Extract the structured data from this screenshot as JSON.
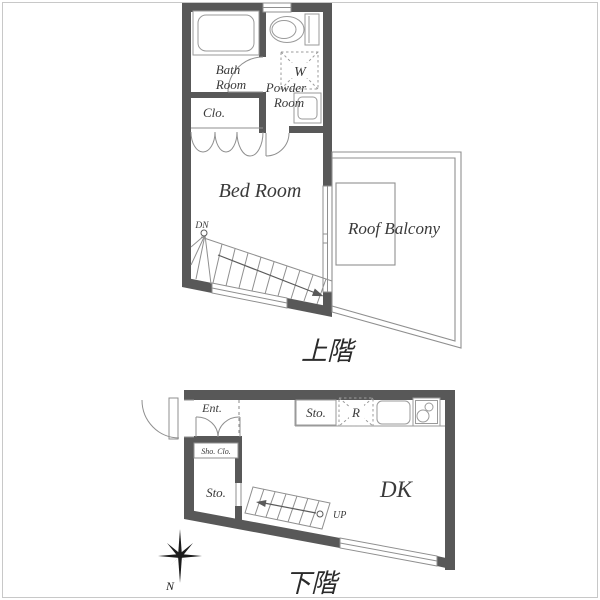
{
  "image": {
    "kind": "apartment floor plan",
    "background": "#ffffff",
    "border_color": "#c8c8c8"
  },
  "colors": {
    "wall": "#585858",
    "line": "#8f8f8f",
    "fixture": "#9a9a9a",
    "dashed": "#9b9b9b",
    "text": "#3a3a3a",
    "caption": "#2b2b2b",
    "arrow": "#5a5a5a",
    "compass": "#1c1c1c",
    "white": "#ffffff"
  },
  "upper_floor": {
    "caption": "上階",
    "labels": {
      "bath_room_line1": "Bath",
      "bath_room_line2": "Room",
      "closet": "Clo.",
      "washing_machine": "W",
      "powder_room_line1": "Powder",
      "powder_room_line2": "Room",
      "bedroom": "Bed Room",
      "stairs_down": "DN",
      "roof_balcony": "Roof Balcony"
    }
  },
  "lower_floor": {
    "caption": "下階",
    "labels": {
      "entrance": "Ent.",
      "shoe_closet": "Sho. Clo.",
      "storage": "Sto.",
      "kitchen_storage": "Sto.",
      "refrigerator": "R",
      "dining_kitchen": "DK",
      "stairs_up": "UP"
    }
  },
  "compass": {
    "north": "N"
  }
}
